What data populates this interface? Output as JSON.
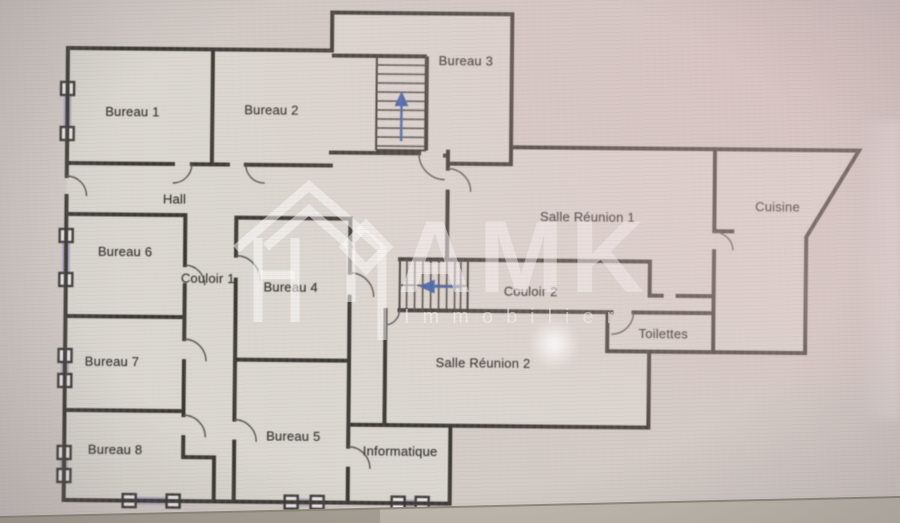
{
  "image": {
    "kind": "floor-plan-photo"
  },
  "rooms": [
    {
      "label": "Bureau 1"
    },
    {
      "label": "Bureau 2"
    },
    {
      "label": "Bureau 3"
    },
    {
      "label": "Hall"
    },
    {
      "label": "Salle Réunion 1"
    },
    {
      "label": "Cuisine"
    },
    {
      "label": "Bureau 6"
    },
    {
      "label": "Couloir 1"
    },
    {
      "label": "Bureau 4"
    },
    {
      "label": "Couloir 2"
    },
    {
      "label": "Toilettes"
    },
    {
      "label": "Bureau 7"
    },
    {
      "label": "Salle Réunion 2"
    },
    {
      "label": "Bureau 8"
    },
    {
      "label": "Bureau 5"
    },
    {
      "label": "Informatique"
    }
  ],
  "watermark": {
    "brand": "AMK",
    "tagline": "Immobilier"
  },
  "colors": {
    "wall": "#3a3732",
    "floor": "#dcd8d0",
    "background": "#d1cac5",
    "window_marker": "#aea6c6",
    "arrow_blue": "#3c5ea9",
    "watermark": "#ffffff"
  }
}
